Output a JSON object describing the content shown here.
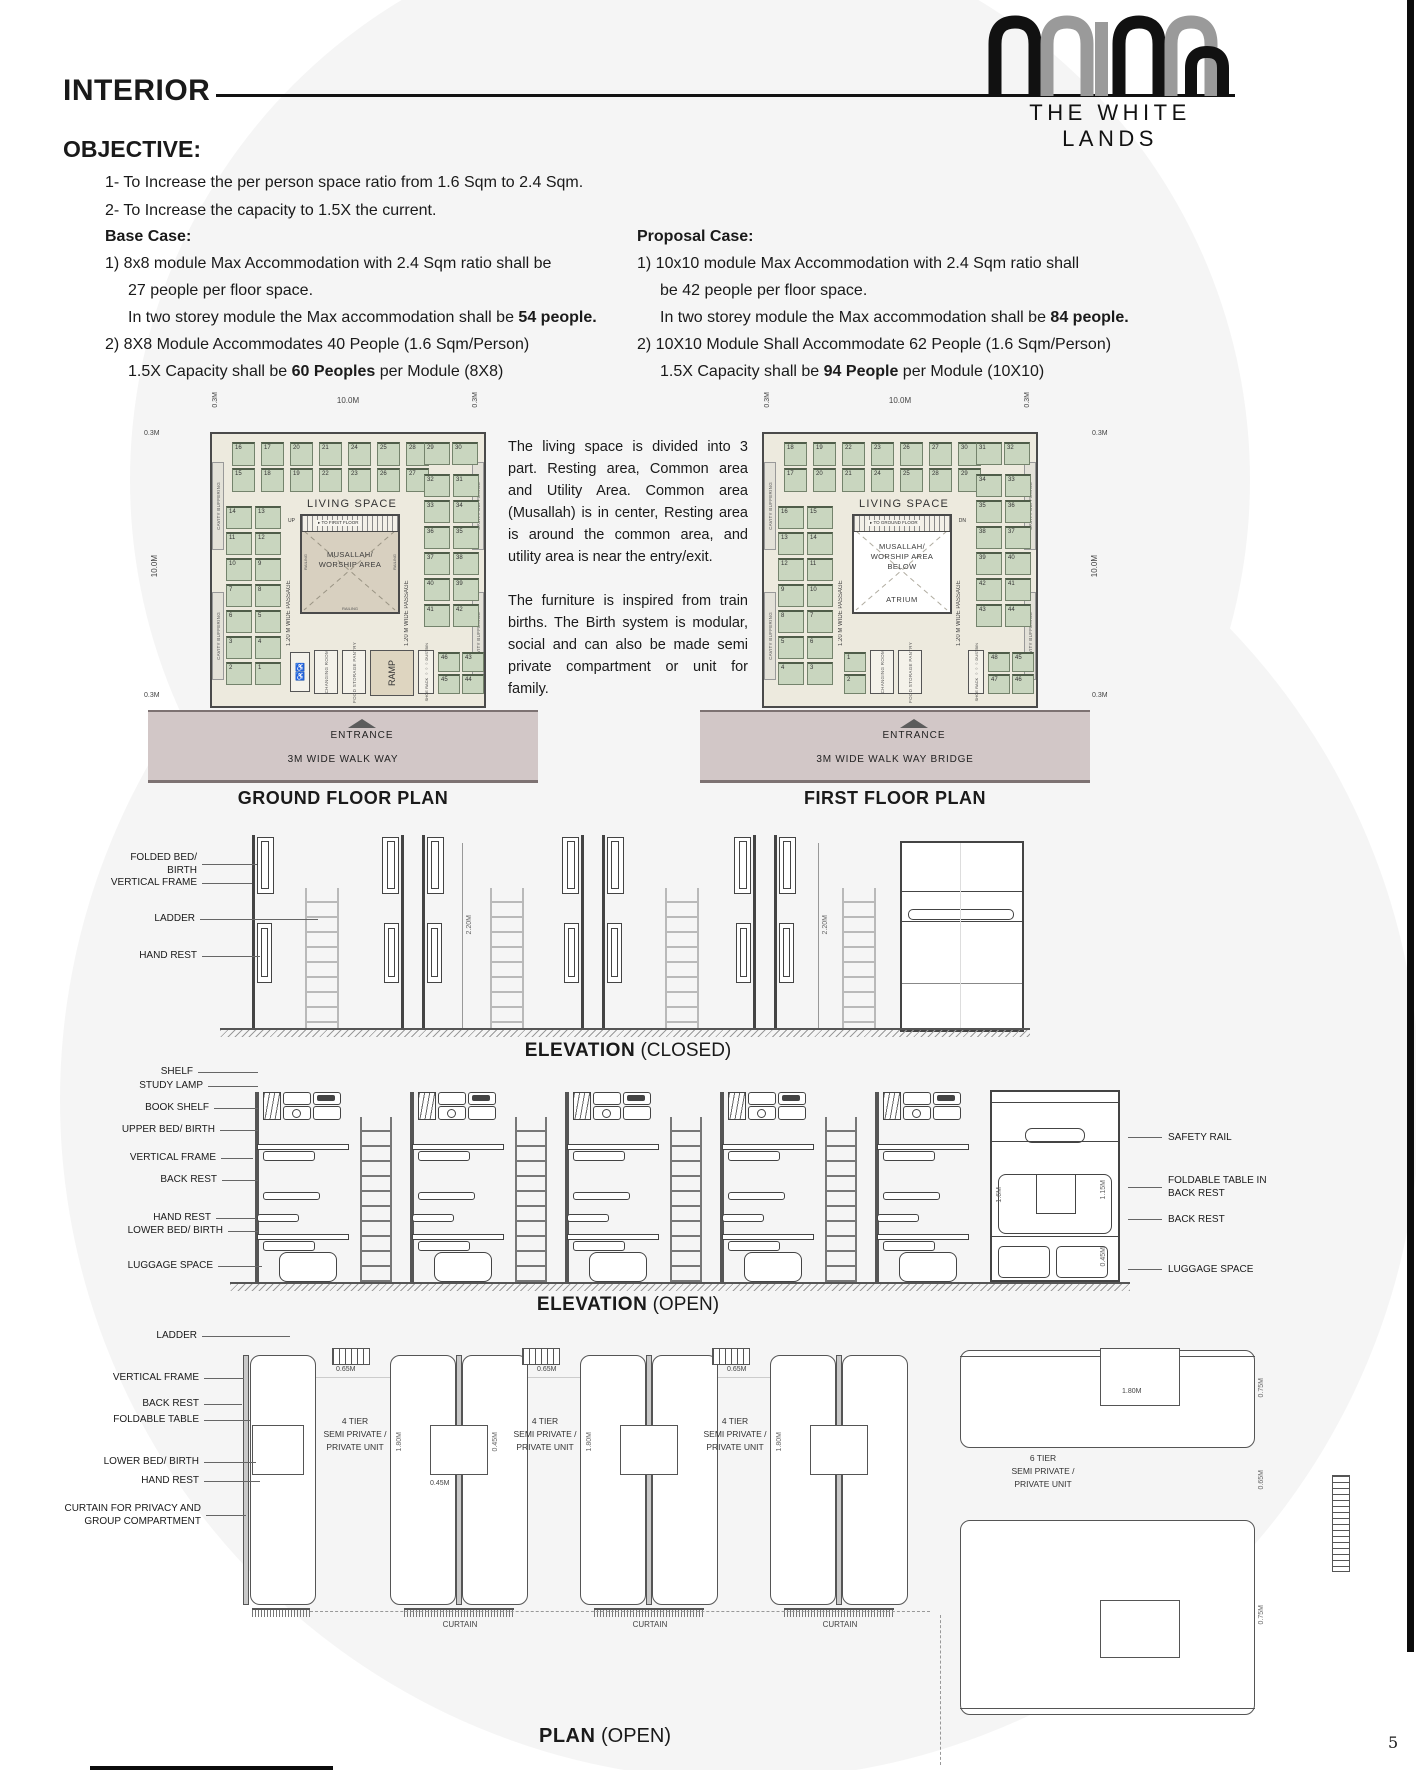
{
  "page": {
    "number": "5"
  },
  "header": {
    "title": "INTERIOR",
    "brand": "THE WHITE LANDS"
  },
  "objective": {
    "heading": "OBJECTIVE:",
    "goal1": "1- To Increase the per person space ratio from 1.6 Sqm to 2.4 Sqm.",
    "goal2": "2- To Increase the capacity to 1.5X the current.",
    "base": {
      "heading": "Base Case:",
      "l1": "1)  8x8 module Max Accommodation with 2.4 Sqm ratio shall be",
      "l2": "27 people per floor space.",
      "l3a": "In two storey module the Max accommodation shall be ",
      "l3b": "54 people.",
      "l4": "2)  8X8 Module Accommodates 40 People (1.6 Sqm/Person)",
      "l5a": "1.5X Capacity shall be ",
      "l5b": "60 Peoples",
      "l5c": " per Module (8X8)"
    },
    "proposal": {
      "heading": "Proposal Case:",
      "l1": "1)  10x10 module Max Accommodation with 2.4 Sqm ratio shall",
      "l2": "be 42 people per floor space.",
      "l3a": "In two storey module the Max accommodation shall be ",
      "l3b": "84 people.",
      "l4": "2)  10X10 Module Shall Accommodate 62 People (1.6 Sqm/Person)",
      "l5a": "1.5X Capacity shall be ",
      "l5b": "94 People",
      "l5c": " per Module (10X10)"
    }
  },
  "description": {
    "para1": "The living space is divided into 3 part. Resting area, Common area and Utility Area. Common area (Musallah) is in center, Resting area is around the common area, and utility area is near the entry/exit.",
    "para2": "The furniture is inspired from train births. The Birth system is modular, social and can also be made semi private compartment or unit for family."
  },
  "ground_plan": {
    "title": "GROUND FLOOR PLAN",
    "dim_side": "0.3M",
    "dim_main": "10.0M",
    "living_space": "LIVING SPACE",
    "musallah1": "MUSALLAH/",
    "musallah2": "WORSHIP AREA",
    "stair_dir": "UP",
    "stair_label": "TO FIRST FLOOR",
    "passage": "1.20 M WIDE PASSAGE",
    "cavity": "CAVITY BUFFERING",
    "railing": "RAILING",
    "changing_room": "CHANGING ROOM",
    "food_storage": "FOOD STORAGE PANTRY",
    "ramp": "RAMP",
    "shoe_rack": "SHOE RACK",
    "dustbin": "DUSTBIN",
    "entrance": "ENTRANCE",
    "walkway": "3M WIDE WALK WAY",
    "beds_top": [
      "16",
      "17",
      "20",
      "21",
      "24",
      "25",
      "28",
      "15",
      "18",
      "19",
      "22",
      "23",
      "26",
      "27"
    ],
    "beds_top_pair": [
      "29",
      "30"
    ],
    "beds_left": [
      "14",
      "13",
      "11",
      "12",
      "10",
      "9",
      "7",
      "8",
      "6",
      "5",
      "3",
      "4",
      "2",
      "1"
    ],
    "beds_right": [
      "32",
      "31",
      "33",
      "34",
      "36",
      "35",
      "37",
      "38",
      "40",
      "39",
      "41",
      "42"
    ],
    "beds_bottom_a": [
      "46",
      "45"
    ],
    "beds_bottom_b": [
      "43",
      "44"
    ]
  },
  "first_plan": {
    "title": "FIRST FLOOR PLAN",
    "dim_side": "0.3M",
    "dim_main": "10.0M",
    "living_space": "LIVING SPACE",
    "musallah1": "MUSALLAH/",
    "musallah2": "WORSHIP AREA",
    "musallah3": "BELOW",
    "atrium": "ATRIUM",
    "stair_dir": "DN",
    "stair_label": "TO GROUND FLOOR",
    "passage": "1.20 M WIDE PASSAGE",
    "cavity": "CAVITY BUFFERING",
    "changing_room": "CHANGING ROOM",
    "food_storage": "FOOD STORAGE PANTRY",
    "shoe_rack": "SHOE RACK",
    "dustbin": "DUSTBIN",
    "entrance": "ENTRANCE",
    "walkway": "3M WIDE WALK WAY BRIDGE",
    "beds_top": [
      "18",
      "19",
      "22",
      "23",
      "26",
      "27",
      "30",
      "17",
      "20",
      "21",
      "24",
      "25",
      "28",
      "29"
    ],
    "beds_top_pair": [
      "31",
      "32"
    ],
    "beds_left": [
      "16",
      "15",
      "13",
      "14",
      "12",
      "11",
      "9",
      "10",
      "8",
      "7",
      "5",
      "6",
      "4",
      "3"
    ],
    "beds_right": [
      "34",
      "33",
      "35",
      "36",
      "38",
      "37",
      "39",
      "40",
      "42",
      "41",
      "43",
      "44"
    ],
    "beds_bottom_a": [
      "1",
      "2"
    ],
    "beds_bottom_b": [
      "48",
      "47"
    ],
    "beds_bottom_c": [
      "45",
      "46"
    ]
  },
  "elevation_closed": {
    "title": "ELEVATION",
    "title_suffix": " (CLOSED)",
    "labels": {
      "folded_bed": "FOLDED BED/ BIRTH",
      "vertical_frame": "VERTICAL FRAME",
      "ladder": "LADDER",
      "hand_rest": "HAND REST"
    },
    "dim": "2.20M"
  },
  "elevation_open": {
    "title": "ELEVATION",
    "title_suffix": " (OPEN)",
    "left_labels": [
      "SHELF",
      "STUDY LAMP",
      "BOOK SHELF",
      "UPPER BED/ BIRTH",
      "VERTICAL FRAME",
      "BACK REST",
      "HAND REST",
      "LOWER BED/ BIRTH",
      "LUGGAGE SPACE"
    ],
    "right_labels": [
      "SAFETY RAIL",
      "FOLDABLE TABLE IN BACK REST",
      "BACK REST",
      "LUGGAGE SPACE"
    ],
    "dim_a": "1.6M",
    "dim_b": "1.15M",
    "dim_c": "0.45M"
  },
  "plan_open": {
    "title": "PLAN",
    "title_suffix": " (OPEN)",
    "left_labels": [
      "LADDER",
      "VERTICAL FRAME",
      "BACK REST",
      "FOLDABLE TABLE",
      "LOWER BED/ BIRTH",
      "HAND REST",
      "CURTAIN FOR PRIVACY AND",
      "GROUP COMPARTMENT"
    ],
    "unit4": [
      "4 TIER",
      "SEMI PRIVATE /",
      "PRIVATE UNIT"
    ],
    "unit6": [
      "6 TIER",
      "SEMI PRIVATE /",
      "PRIVATE UNIT"
    ],
    "curtain": "CURTAIN",
    "dim_075": "0.75M",
    "dim_065": "0.65M",
    "dim_180": "1.80M",
    "dim_045": "0.45M"
  },
  "colors": {
    "bed_green": "#c9d6bf",
    "floor_cream": "#edeade",
    "walkway": "#d2c7c7",
    "musallah_tan": "#d8d0c0",
    "accent_black": "#0c0c0c"
  }
}
